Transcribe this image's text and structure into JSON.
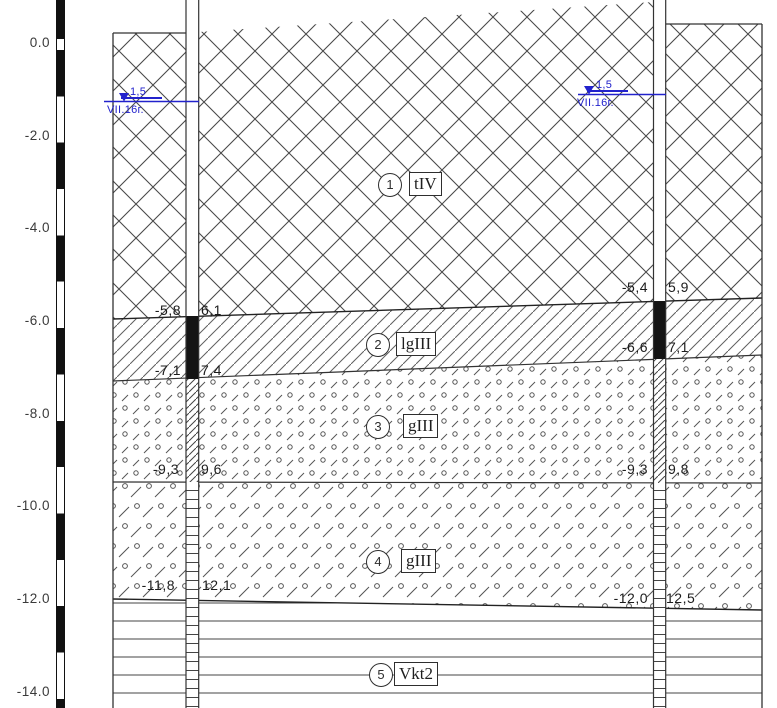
{
  "title": "Geological cross-section with sheet piles",
  "ruler": {
    "unit": "m",
    "ticks": [
      "0.0",
      "-2.0",
      "-4.0",
      "-6.0",
      "-8.0",
      "-10.0",
      "-12.0",
      "-14.0"
    ]
  },
  "water": {
    "left": {
      "symbol": "groundwater-level",
      "level": "1,5",
      "date": "VII.16г."
    },
    "right": {
      "symbol": "groundwater-level",
      "level": "1,5",
      "date": "VII.16г."
    }
  },
  "layers": [
    {
      "num": "1",
      "index": "tIV",
      "pattern": "cross-hatch"
    },
    {
      "num": "2",
      "index": "lgIII",
      "pattern": "diagonal-lines"
    },
    {
      "num": "3",
      "index": "gIII",
      "pattern": "circles-and-short-slashes"
    },
    {
      "num": "4",
      "index": "gIII",
      "pattern": "circles-and-long-slashes"
    },
    {
      "num": "5",
      "index": "Vkt2",
      "pattern": "horizontal-lines"
    }
  ],
  "annotations": {
    "left_pile": [
      {
        "elevation": "-5,8",
        "depth": "6,1"
      },
      {
        "elevation": "-7,1",
        "depth": "7,4"
      },
      {
        "elevation": "-9,3",
        "depth": "9,6"
      },
      {
        "elevation": "-11,8",
        "depth": "12,1"
      }
    ],
    "right_pile": [
      {
        "elevation": "-5,4",
        "depth": "5,9"
      },
      {
        "elevation": "-6,6",
        "depth": "7,1"
      },
      {
        "elevation": "-9,3",
        "depth": "9,8"
      },
      {
        "elevation": "-12,0",
        "depth": "12,5"
      }
    ]
  },
  "colors": {
    "water_blue": "#2222cc",
    "line_dark": "#333333",
    "pile_black": "#141414"
  }
}
